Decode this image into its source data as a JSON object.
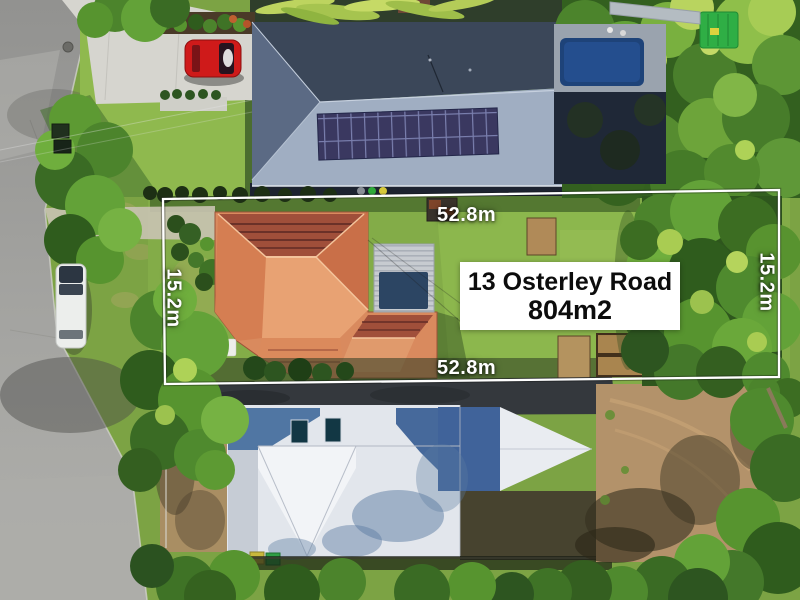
{
  "overlay": {
    "address_box": {
      "line1": "13 Osterley Road",
      "line2": "804m2"
    },
    "dimension_labels": {
      "top": "52.8m",
      "bottom": "52.8m",
      "left": "15.2m",
      "right": "15.2m"
    },
    "boundary_color": "#ffffff",
    "label_text_color": "#ffffff",
    "address_text_color": "#0c0c0c",
    "address_box_bg": "#ffffff"
  },
  "palette": {
    "road": "#a3a3a0",
    "grass": "#7ca344",
    "subject_roof_terracotta": "#d98a5e",
    "neighbor_roof_dark": "#3b4759",
    "neighbor_roof_light": "#e2e6ec",
    "solar_panels": "#32365c",
    "pool_water": "#1e4379",
    "dirt": "#b3926a",
    "trees": "#33601f",
    "red_car": "#cf1a1a",
    "white_car": "#eceeec",
    "asphalt_drive": "#34383d"
  }
}
